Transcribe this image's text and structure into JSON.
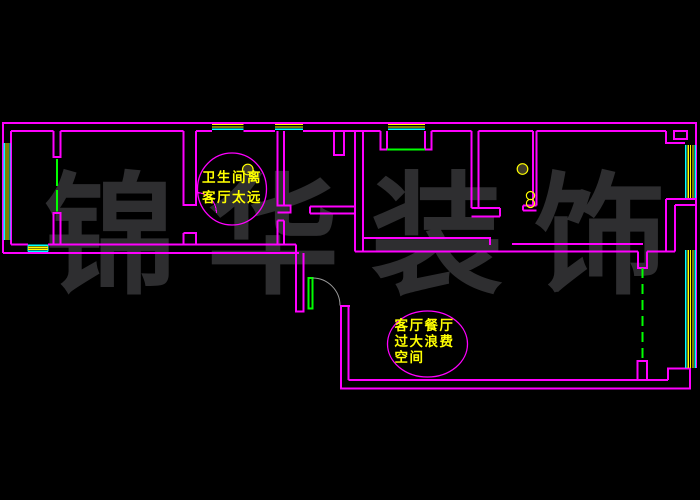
{
  "palette": {
    "background": "#000000",
    "walls": "#FF00FF",
    "window_frame": "#00FFFF",
    "window_glass": "#FFFF00",
    "door_glass_and_sliding_panels": "#00FF00",
    "entry_door_swing_arc": "#9B9B9B",
    "annotation_text": "#FFFF00",
    "watermark_text": "#2E2E30"
  },
  "watermark": {
    "text": "锦华装饰",
    "chars": [
      "锦",
      "华",
      "装",
      "饰"
    ]
  },
  "annotations": {
    "bathroom_note": {
      "lines": [
        "卫生间离",
        "客厅太远"
      ]
    },
    "living_note": {
      "lines": [
        "客厅餐厅",
        "过大浪费",
        "空间"
      ]
    }
  },
  "symbols": {
    "lamp_bathroom": "ceiling-lamp-symbol",
    "lamp_kitchen": "ceiling-lamp-symbol",
    "sink_kitchen": "double-bowl-sink-symbol"
  }
}
